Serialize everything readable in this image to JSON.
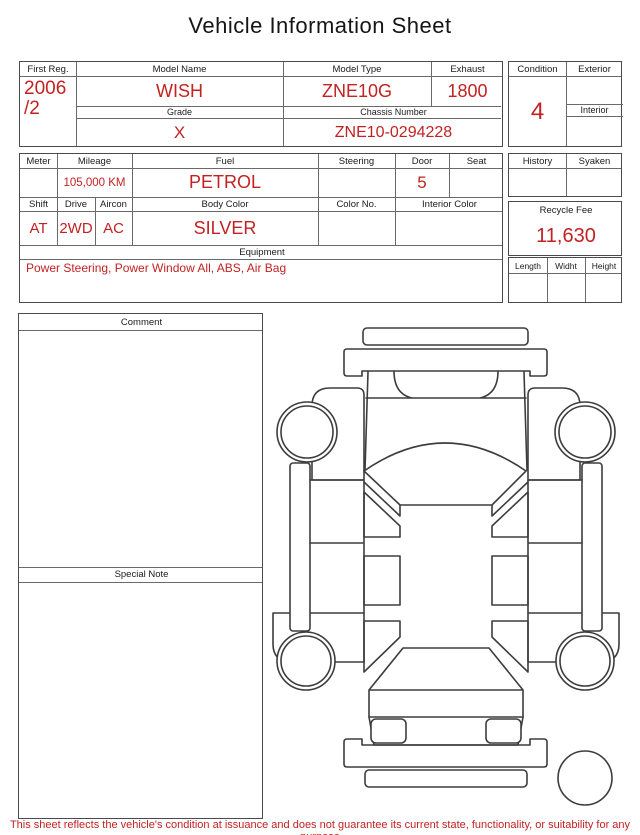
{
  "title": "Vehicle Information Sheet",
  "t1": {
    "first_reg_label": "First Reg.",
    "first_reg_value": "2006",
    "first_reg_value2": "/2",
    "model_name_label": "Model Name",
    "model_name_value": "WISH",
    "model_type_label": "Model Type",
    "model_type_value": "ZNE10G",
    "exhaust_label": "Exhaust",
    "exhaust_value": "1800",
    "grade_label": "Grade",
    "grade_value": "X",
    "chassis_label": "Chassis Number",
    "chassis_value": "ZNE10-0294228"
  },
  "condition_box": {
    "condition_label": "Condition",
    "condition_value": "4",
    "exterior_label": "Exterior",
    "exterior_value": "",
    "interior_label": "Interior",
    "interior_value": ""
  },
  "t2": {
    "meter_label": "Meter",
    "meter_value": "",
    "mileage_label": "Mileage",
    "mileage_value": "105,000 KM",
    "fuel_label": "Fuel",
    "fuel_value": "PETROL",
    "steering_label": "Steering",
    "steering_value": "",
    "door_label": "Door",
    "door_value": "5",
    "seat_label": "Seat",
    "seat_value": "",
    "shift_label": "Shift",
    "shift_value": "AT",
    "drive_label": "Drive",
    "drive_value": "2WD",
    "aircon_label": "Aircon",
    "aircon_value": "AC",
    "body_color_label": "Body Color",
    "body_color_value": "SILVER",
    "color_no_label": "Color No.",
    "color_no_value": "",
    "interior_color_label": "Interior Color",
    "interior_color_value": "",
    "equipment_label": "Equipment",
    "equipment_value": "Power Steering, Power Window  All, ABS, Air Bag"
  },
  "history_box": {
    "history_label": "History",
    "syaken_label": "Syaken"
  },
  "recycle_box": {
    "label": "Recycle Fee",
    "value": "11,630"
  },
  "dims_box": {
    "length_label": "Length",
    "width_label": "Widht",
    "height_label": "Height"
  },
  "notes": {
    "comment_label": "Comment",
    "comment_text": "",
    "special_note_label": "Special Note",
    "special_note_text": ""
  },
  "diagram": {
    "name": "vehicle-top-view-outline"
  },
  "footer": {
    "disclaimer": "This sheet reflects the vehicle's condition at issuance and does not guarantee its current state, functionality, or suitability for any purpose"
  },
  "colors": {
    "value_red": "#c32222",
    "grid_dark": "#4a4a4a",
    "grid_light": "#6a6a6a",
    "car_outline": "#3d3d3d"
  }
}
